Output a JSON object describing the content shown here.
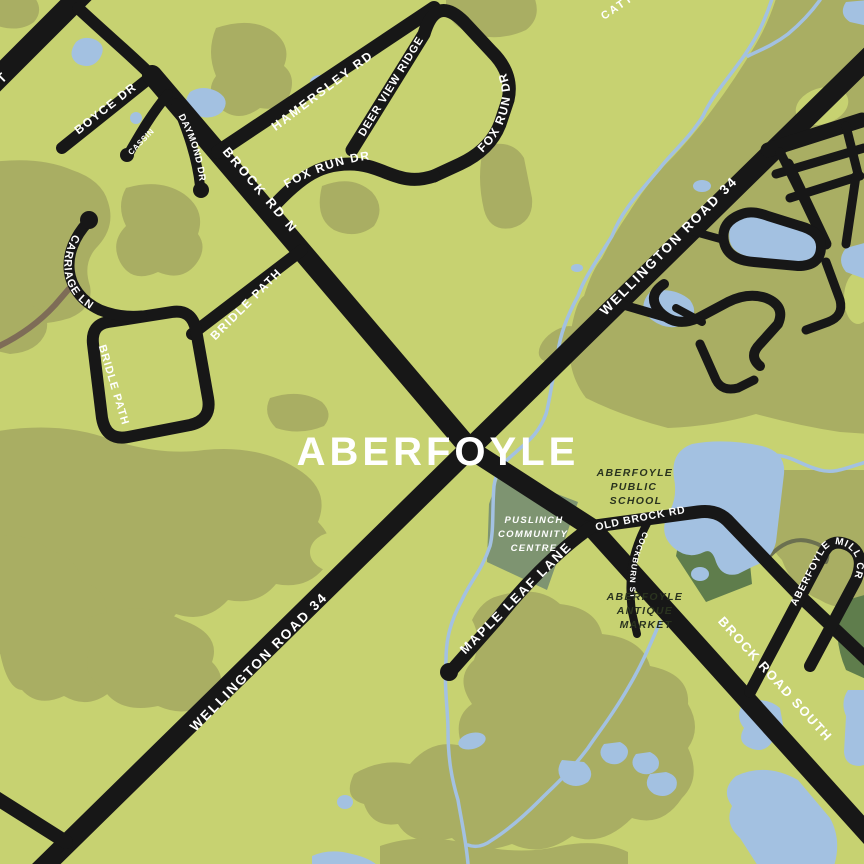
{
  "map": {
    "title": "ABERFOYLE",
    "road_labels": {
      "wellington_road_34": "WELLINGTON ROAD 34",
      "brock_rd_n": "BROCK RD N",
      "brock_road_south": "BROCK ROAD SOUTH",
      "old_brock_rd": "OLD BROCK RD",
      "boyce_dr": "BOYCE DR",
      "cassin": "CASSIN",
      "daymond_dr": "DAYMOND DR",
      "hamersley_rd": "HAMERSLEY RD",
      "deer_view_ridge": "DEER VIEW RIDGE",
      "fox_run_dr": "FOX RUN DR",
      "carriage_ln": "CARRIAGE LN",
      "bridle_path": "BRIDLE PATH",
      "maple_leaf_lane": "MAPLE LEAF LANE",
      "cockburn_st": "COCKBURN ST",
      "aberfoyle_mill_cr": "ABERFOYLE MILL CR",
      "edge_fragment_left": "T",
      "edge_fragment_top": "CATT"
    },
    "places": {
      "puslinch_community_centre": [
        "PUSLINCH",
        "COMMUNITY",
        "CENTRE"
      ],
      "aberfoyle_public_school": [
        "ABERFOYLE",
        "PUBLIC",
        "SCHOOL"
      ],
      "aberfoyle_antique_market": [
        "ABERFOYLE",
        "ANTIQUE",
        "MARKET"
      ]
    },
    "colors": {
      "background_green": "#c7d271",
      "terrain_olive": "#a9ae63",
      "facility_sage": "#7e9471",
      "facility_deep_green": "#5f7d4c",
      "water_blue": "#a3c1e1",
      "road_black": "#171717",
      "label_white": "#ffffff",
      "poi_text_dark": "#2a331f",
      "trail_brown": "#7e6c57",
      "trail_gray": "#6b7050"
    }
  }
}
